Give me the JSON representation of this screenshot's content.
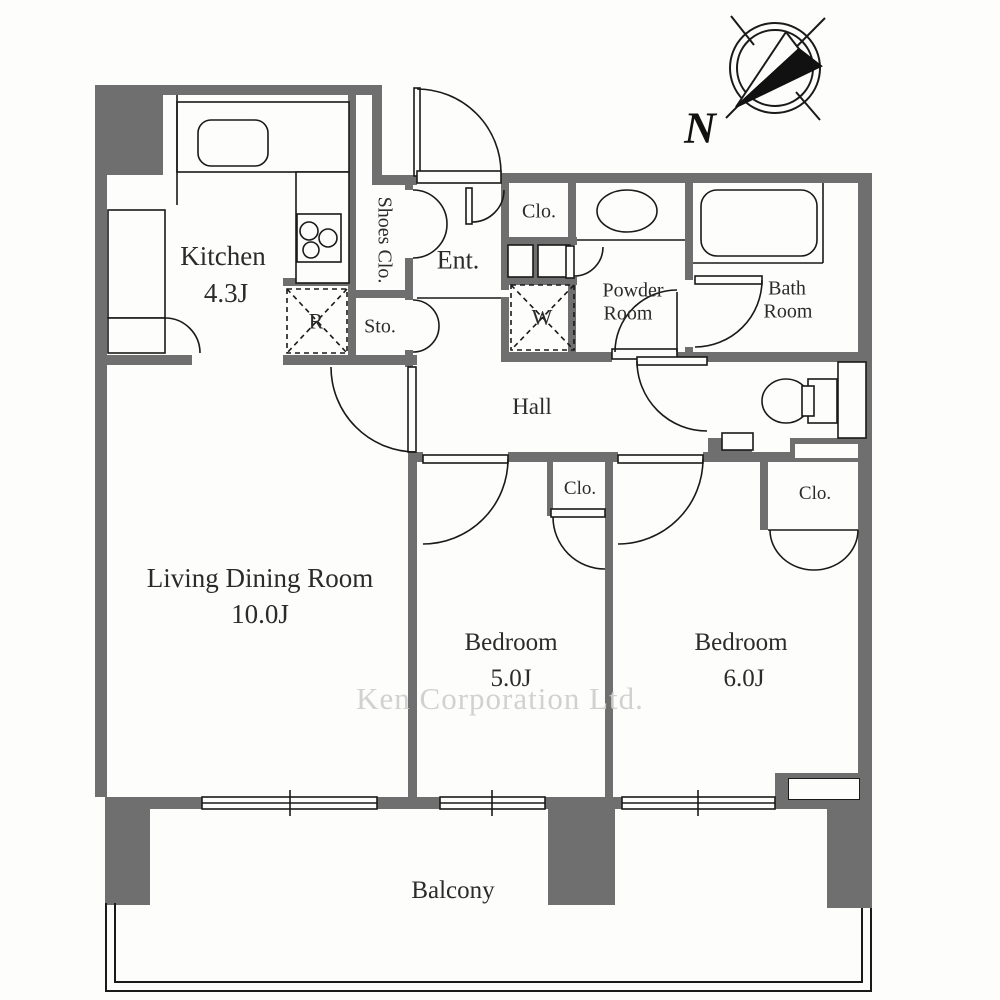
{
  "colors": {
    "wall": "#6f6f6f",
    "line": "#1a1a1a",
    "bg": "#fdfdfb",
    "text": "#2b2b2b",
    "watermark": "#cfcfcf"
  },
  "rooms": {
    "kitchen": {
      "name": "Kitchen",
      "size": "4.3J"
    },
    "living": {
      "name": "Living Dining Room",
      "size": "10.0J"
    },
    "bedroom5": {
      "name": "Bedroom",
      "size": "5.0J"
    },
    "bedroom6": {
      "name": "Bedroom",
      "size": "6.0J"
    },
    "hall": {
      "name": "Hall"
    },
    "entrance": {
      "name": "Ent."
    },
    "balcony": {
      "name": "Balcony"
    },
    "shoes_closet": {
      "name": "Shoes Clo."
    },
    "storage": {
      "name": "Sto."
    },
    "powder_room": {
      "line1": "Powder",
      "line2": "Room"
    },
    "bath_room": {
      "line1": "Bath",
      "line2": "Room"
    },
    "closet_entrance": {
      "name": "Clo."
    },
    "closet_bedroom5": {
      "name": "Clo."
    },
    "closet_bedroom6": {
      "name": "Clo."
    }
  },
  "symbols": {
    "refrigerator": "R",
    "washer": "W",
    "compass_north": "N"
  },
  "watermark": "Ken Corporation Ltd."
}
